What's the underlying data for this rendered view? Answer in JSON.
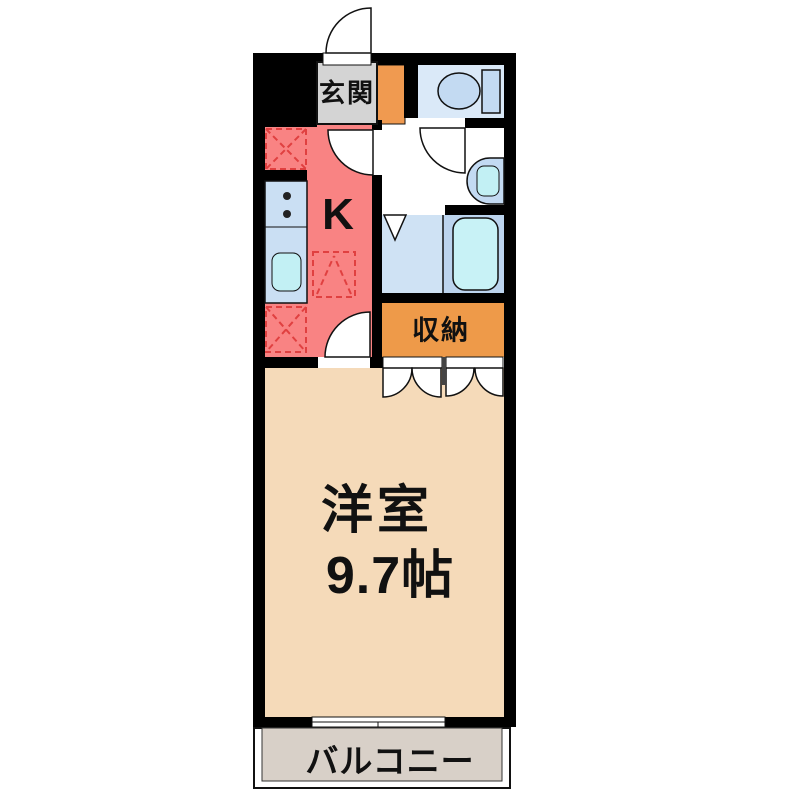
{
  "title": "apartment-floor-plan",
  "labels": {
    "entrance": "玄関",
    "kitchen": "K",
    "storage": "収納",
    "main_room_name": "洋室",
    "main_room_size": "9.7帖",
    "balcony": "バルコニー"
  },
  "colors": {
    "wall": "#000000",
    "kitchen": "#F98383",
    "entrance_hall": "#D4D4D4",
    "entrance_side_cabinet": "#F09A50",
    "storage": "#EE9A49",
    "main_room": "#F5DAB9",
    "balcony": "#D8D0C8",
    "toilet_room": "#DAE9F8",
    "bathroom_left": "#CFE2F4",
    "bathroom_right": "#BCD4EE",
    "bathtub": "#C8F2F6",
    "counter": "#CADFF3",
    "sink": "#C2F0F4",
    "fixture": "#C3DAF2",
    "dashed_symbol": "#E04040",
    "text": "#111111"
  },
  "icons": [
    "toilet-icon",
    "washbasin-icon",
    "bathtub-icon",
    "kitchen-counter-icon",
    "stove-icon",
    "kitchen-sink-icon",
    "entrance-door-swing",
    "washroom-door-swing",
    "kitchen-door-swing",
    "bathroom-folding-door",
    "closet-folding-doors",
    "sliding-window",
    "fridge-space-symbol",
    "appliance-space-symbol"
  ]
}
